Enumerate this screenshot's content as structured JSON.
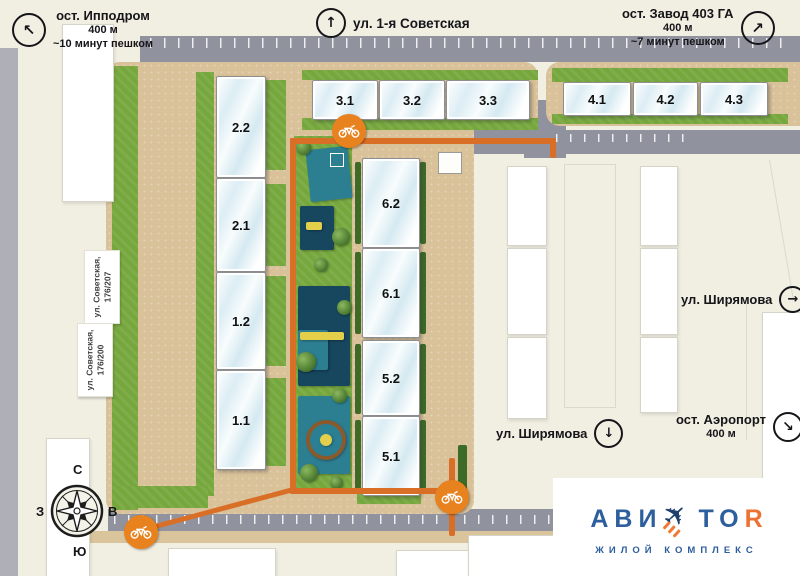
{
  "colors": {
    "background": "#f1efe2",
    "road": "#90929e",
    "sand": "#d9c199",
    "grass": "#76a73d",
    "hedge": "#3c6b28",
    "bike_path": "#d96f27",
    "bike_marker": "#e8821f",
    "playground_teal": "#2c7e91",
    "playground_navy": "#17465f",
    "playground_yellow": "#e4cf4a",
    "logo_blue": "#2d5e9d",
    "logo_orange": "#ed7133"
  },
  "nav": {
    "hippodrome": {
      "arrow": "↖",
      "title": "ост. Ипподром",
      "distance": "400 м",
      "walk": "~10 минут пешком"
    },
    "sovetskaya": {
      "arrow": "↑",
      "title": "ул. 1-я Советская"
    },
    "zavod": {
      "arrow": "↗",
      "title": "ост. Завод 403 ГА",
      "distance": "400 м",
      "walk": "~7 минут пешком"
    },
    "shiryamova_right": {
      "arrow": "→",
      "title": "ул. Ширямова"
    },
    "shiryamova_down": {
      "arrow": "↓",
      "title": "ул. Ширямова"
    },
    "airport": {
      "arrow": "↘",
      "title": "ост. Аэропорт",
      "distance": "400 м"
    }
  },
  "addresses": [
    {
      "line1": "ул. Советская,",
      "line2": "176/207"
    },
    {
      "line1": "ул. Советская,",
      "line2": "176/200"
    }
  ],
  "buildings": {
    "left_column": [
      "2.2",
      "2.1",
      "1.2",
      "1.1"
    ],
    "row_3": [
      "3.1",
      "3.2",
      "3.3"
    ],
    "row_4": [
      "4.1",
      "4.2",
      "4.3"
    ],
    "center_column": [
      "6.2",
      "6.1",
      "5.2",
      "5.1"
    ]
  },
  "compass": {
    "n": "С",
    "s": "Ю",
    "w": "З",
    "e": "В"
  },
  "logo": {
    "part1": "АВИ",
    "part2": "ТО",
    "part3": "R",
    "subtitle": "ЖИЛОЙ КОМПЛЕКС"
  }
}
